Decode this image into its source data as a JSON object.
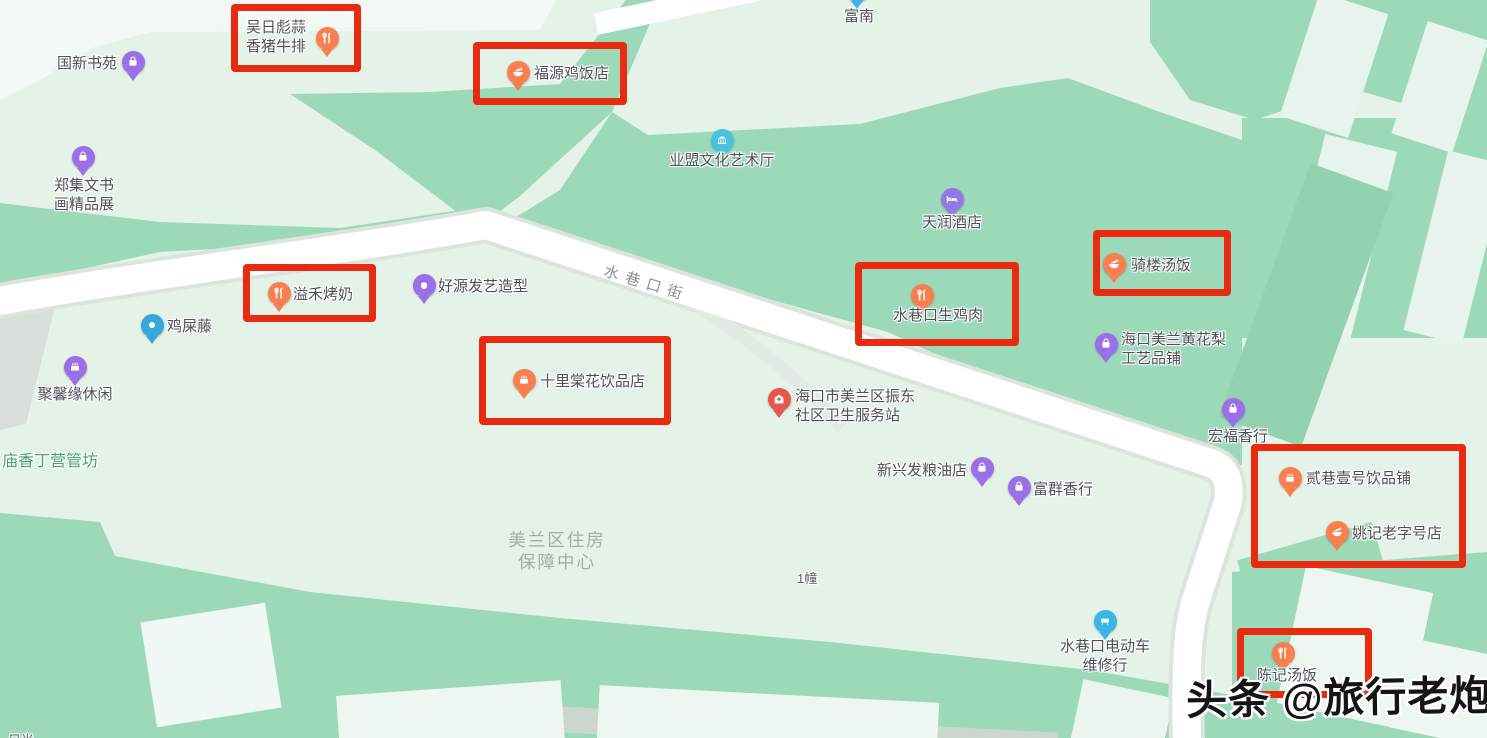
{
  "watermark": {
    "text": "头条 @旅行老炮"
  },
  "map": {
    "colors": {
      "highlight_red": "#E82A10",
      "land_base": "#E4F2E8",
      "land_block_green": "#9CD9B9",
      "road_white": "#FFFFFF",
      "pin_orange": "#F97E50",
      "pin_purple": "#9B6FE8",
      "pin_blue": "#41B1EC",
      "pin_cyan": "#4BC2DD",
      "pin_red": "#E4574F"
    },
    "pins": [
      {
        "name": "guoxin-shuyuan",
        "icon": "bag-icon",
        "color": "#9B6FE8",
        "x": 133,
        "y": 62
      },
      {
        "name": "wuribiao-steak",
        "icon": "fork-knife-icon",
        "color": "#F97E50",
        "x": 327,
        "y": 38
      },
      {
        "name": "fuyuan-chicken-rice",
        "icon": "bowl-icon",
        "color": "#F97E50",
        "x": 518,
        "y": 72
      },
      {
        "name": "funan",
        "icon": "dot-icon",
        "color": "#41B1EC",
        "x": 857,
        "y": -10
      },
      {
        "name": "yemeng-art-hall",
        "icon": "building-icon",
        "color": "#4BC2DD",
        "x": 722,
        "y": 140
      },
      {
        "name": "zhengji-calligraphy",
        "icon": "bag-icon",
        "color": "#9B6FE8",
        "x": 83,
        "y": 157
      },
      {
        "name": "tianrun-hotel",
        "icon": "bed-icon",
        "color": "#8E7BE5",
        "x": 952,
        "y": 199
      },
      {
        "name": "qilou-soup-rice",
        "icon": "bowl-icon",
        "color": "#F97E50",
        "x": 1114,
        "y": 264
      },
      {
        "name": "haoyuan-hair-salon",
        "icon": "face-icon",
        "color": "#9B6FE8",
        "x": 424,
        "y": 285
      },
      {
        "name": "yihe-roasted-milk",
        "icon": "fork-knife-icon",
        "color": "#F97E50",
        "x": 279,
        "y": 293
      },
      {
        "name": "shuixiangkou-raw-chicken",
        "icon": "fork-knife-icon",
        "color": "#F97E50",
        "x": 922,
        "y": 295
      },
      {
        "name": "jishiteng",
        "icon": "dot-icon",
        "color": "#35A8DC",
        "x": 152,
        "y": 325
      },
      {
        "name": "huanghuali-craft-shop",
        "icon": "bag-icon",
        "color": "#9B6FE8",
        "x": 1106,
        "y": 344
      },
      {
        "name": "juxinyuan-leisure",
        "icon": "cake-icon",
        "color": "#9B6FE8",
        "x": 75,
        "y": 367
      },
      {
        "name": "shilitanghua-drinks",
        "icon": "cake-icon",
        "color": "#F97E50",
        "x": 524,
        "y": 380
      },
      {
        "name": "zhendong-health-station",
        "icon": "cross-house-icon",
        "color": "#E4574F",
        "x": 779,
        "y": 399
      },
      {
        "name": "hongfu-incense",
        "icon": "bag-icon",
        "color": "#9B6FE8",
        "x": 1233,
        "y": 409
      },
      {
        "name": "xinxingfa-grain-oil",
        "icon": "bag-icon",
        "color": "#9B6FE8",
        "x": 982,
        "y": 468
      },
      {
        "name": "fuqun-incense",
        "icon": "bag-icon",
        "color": "#9B6FE8",
        "x": 1019,
        "y": 487
      },
      {
        "name": "erxiang-yihao-drinks",
        "icon": "cake-icon",
        "color": "#F97E50",
        "x": 1290,
        "y": 478
      },
      {
        "name": "yaoji-laozihao",
        "icon": "bowl-icon",
        "color": "#F97E50",
        "x": 1337,
        "y": 532
      },
      {
        "name": "ebike-repair",
        "icon": "scooter-icon",
        "color": "#3CB5E8",
        "x": 1105,
        "y": 621
      },
      {
        "name": "chenji-soup-rice",
        "icon": "fork-knife-icon",
        "color": "#F97E50",
        "x": 1283,
        "y": 653
      }
    ],
    "labels": [
      {
        "name": "guoxin-shuyuan",
        "text": "国新书苑",
        "x": 57,
        "y": 54
      },
      {
        "name": "wuribiao-steak",
        "text": "吴日彪蒜\n香猪牛排",
        "x": 246,
        "y": 18
      },
      {
        "name": "fuyuan-chicken-rice",
        "text": "福源鸡饭店",
        "x": 534,
        "y": 64
      },
      {
        "name": "funan",
        "text": "富南",
        "x": 859,
        "y": 7,
        "anchor": "center"
      },
      {
        "name": "yemeng-art-hall",
        "text": "业盟文化艺术厅",
        "x": 722,
        "y": 151,
        "anchor": "center"
      },
      {
        "name": "zhengji-calligraphy",
        "text": "郑集文书\n画精品展",
        "x": 84,
        "y": 176,
        "anchor": "center"
      },
      {
        "name": "tianrun-hotel",
        "text": "天润酒店",
        "x": 952,
        "y": 213,
        "anchor": "center"
      },
      {
        "name": "qilou-soup-rice",
        "text": "骑楼汤饭",
        "x": 1131,
        "y": 256
      },
      {
        "name": "shuixiangkou-street",
        "text": "水巷口街",
        "x": 607,
        "y": 262,
        "cls": "street",
        "rotate": 17,
        "interactable": false
      },
      {
        "name": "haoyuan-hair-salon",
        "text": "好源发艺造型",
        "x": 438,
        "y": 277
      },
      {
        "name": "yihe-roasted-milk",
        "text": "溢禾烤奶",
        "x": 293,
        "y": 285
      },
      {
        "name": "shuixiangkou-raw-chicken",
        "text": "水巷口生鸡肉",
        "x": 938,
        "y": 306,
        "anchor": "center"
      },
      {
        "name": "jishiteng",
        "text": "鸡屎藤",
        "x": 167,
        "y": 317
      },
      {
        "name": "huanghuali-craft-shop",
        "text": "海口美兰黄花梨\n工艺品铺",
        "x": 1121,
        "y": 330
      },
      {
        "name": "juxinyuan-leisure",
        "text": "聚馨缘休闲",
        "x": 75,
        "y": 385,
        "anchor": "center"
      },
      {
        "name": "shilitanghua-drinks",
        "text": "十里棠花饮品店",
        "x": 540,
        "y": 372
      },
      {
        "name": "zhendong-health-station",
        "text": "海口市美兰区振东\n社区卫生服务站",
        "x": 795,
        "y": 387
      },
      {
        "name": "hongfu-incense",
        "text": "宏福香行",
        "x": 1238,
        "y": 427,
        "anchor": "center"
      },
      {
        "name": "miaoxiang-dingying",
        "text": "庙香丁营管坊",
        "x": 2,
        "y": 452,
        "cls": "district",
        "interactable": false
      },
      {
        "name": "xinxingfa-grain-oil",
        "text": "新兴发粮油店",
        "x": 877,
        "y": 461
      },
      {
        "name": "fuqun-incense",
        "text": "富群香行",
        "x": 1033,
        "y": 480
      },
      {
        "name": "erxiang-yihao-drinks",
        "text": "贰巷壹号饮品铺",
        "x": 1306,
        "y": 469
      },
      {
        "name": "yaoji-laozihao",
        "text": "姚记老字号店",
        "x": 1352,
        "y": 524
      },
      {
        "name": "meilan-housing-center",
        "text": "美兰区住房\n保障中心",
        "x": 557,
        "y": 529,
        "anchor": "center",
        "cls": "area",
        "interactable": false
      },
      {
        "name": "building-no-1",
        "text": "1幢",
        "x": 797,
        "y": 569,
        "cls": "small",
        "interactable": false
      },
      {
        "name": "ebike-repair",
        "text": "水巷口电动车\n维修行",
        "x": 1105,
        "y": 637,
        "anchor": "center"
      },
      {
        "name": "chenji-soup-rice",
        "text": "陈记汤饭",
        "x": 1287,
        "y": 666,
        "anchor": "center"
      },
      {
        "name": "corner-partial",
        "text": "日尚",
        "x": 8,
        "y": 731,
        "cls": "small",
        "interactable": false
      }
    ],
    "highlight_boxes": [
      {
        "name": "wuribiao-steak",
        "x": 231,
        "y": 4,
        "w": 130,
        "h": 68
      },
      {
        "name": "fuyuan-chicken-rice",
        "x": 473,
        "y": 42,
        "w": 154,
        "h": 63
      },
      {
        "name": "qilou-soup-rice",
        "x": 1093,
        "y": 230,
        "w": 138,
        "h": 66
      },
      {
        "name": "yihe-roasted-milk",
        "x": 243,
        "y": 264,
        "w": 133,
        "h": 58
      },
      {
        "name": "shuixiangkou-raw-chicken",
        "x": 855,
        "y": 262,
        "w": 164,
        "h": 84
      },
      {
        "name": "shilitanghua-drinks",
        "x": 479,
        "y": 336,
        "w": 192,
        "h": 89
      },
      {
        "name": "erxiang-yaoji-combo",
        "x": 1251,
        "y": 444,
        "w": 215,
        "h": 124
      },
      {
        "name": "chenji-soup-rice",
        "x": 1237,
        "y": 628,
        "w": 135,
        "h": 70
      }
    ]
  }
}
